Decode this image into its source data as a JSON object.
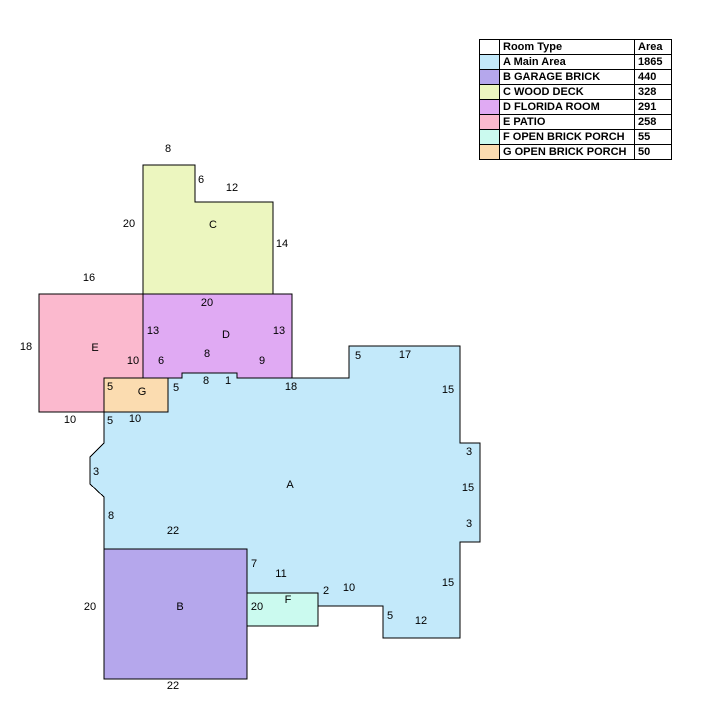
{
  "legend": {
    "header_swatch": "",
    "header_room_type": "Room Type",
    "header_area": "Area",
    "rows": [
      {
        "color": "#C3E9FA",
        "label": "A Main Area",
        "area": "1865"
      },
      {
        "color": "#B5A7EC",
        "label": "B GARAGE BRICK",
        "area": "440"
      },
      {
        "color": "#ECF6BF",
        "label": "C WOOD DECK",
        "area": "328"
      },
      {
        "color": "#E0AAF3",
        "label": "D FLORIDA ROOM",
        "area": "291"
      },
      {
        "color": "#FBB9CE",
        "label": "E PATIO",
        "area": "258"
      },
      {
        "color": "#CBFAEF",
        "label": "F OPEN BRICK PORCH",
        "area": "55"
      },
      {
        "color": "#FBDCB0",
        "label": "G OPEN BRICK PORCH",
        "area": "50"
      }
    ]
  },
  "floorplan": {
    "line_color": "#000000",
    "regions": [
      {
        "id": "A",
        "letter": "A",
        "room_type": "Main Area",
        "color": "#C3E9FA",
        "letter_x": 290,
        "letter_y": 485,
        "points": [
          [
            104,
            412
          ],
          [
            168,
            412
          ],
          [
            168,
            378
          ],
          [
            182,
            378
          ],
          [
            182,
            373
          ],
          [
            237,
            373
          ],
          [
            237,
            378
          ],
          [
            349,
            378
          ],
          [
            349,
            346
          ],
          [
            460,
            346
          ],
          [
            460,
            443
          ],
          [
            480,
            443
          ],
          [
            480,
            542
          ],
          [
            460,
            542
          ],
          [
            460,
            638
          ],
          [
            383,
            638
          ],
          [
            383,
            606
          ],
          [
            317,
            606
          ],
          [
            317,
            593
          ],
          [
            247,
            593
          ],
          [
            247,
            549
          ],
          [
            104,
            549
          ],
          [
            104,
            497
          ],
          [
            90,
            484
          ],
          [
            90,
            457
          ],
          [
            104,
            443
          ]
        ]
      },
      {
        "id": "E",
        "letter": "E",
        "room_type": "PATIO",
        "color": "#FBB9CE",
        "letter_x": 95,
        "letter_y": 348,
        "points": [
          [
            39,
            294
          ],
          [
            143,
            294
          ],
          [
            143,
            378
          ],
          [
            104,
            378
          ],
          [
            104,
            412
          ],
          [
            39,
            412
          ]
        ]
      },
      {
        "id": "C",
        "letter": "C",
        "room_type": "WOOD DECK",
        "color": "#ECF6BF",
        "letter_x": 213,
        "letter_y": 225,
        "points": [
          [
            143,
            165
          ],
          [
            195,
            165
          ],
          [
            195,
            202
          ],
          [
            273,
            202
          ],
          [
            273,
            294
          ],
          [
            143,
            294
          ]
        ]
      },
      {
        "id": "D",
        "letter": "D",
        "room_type": "FLORIDA ROOM",
        "color": "#E0AAF3",
        "letter_x": 226,
        "letter_y": 335,
        "points": [
          [
            143,
            294
          ],
          [
            292,
            294
          ],
          [
            292,
            378
          ],
          [
            237,
            378
          ],
          [
            237,
            373
          ],
          [
            182,
            373
          ],
          [
            182,
            378
          ],
          [
            143,
            378
          ]
        ]
      },
      {
        "id": "G",
        "letter": "G",
        "room_type": "OPEN BRICK PORCH",
        "color": "#FBDCB0",
        "letter_x": 142,
        "letter_y": 392,
        "points": [
          [
            104,
            378
          ],
          [
            168,
            378
          ],
          [
            168,
            412
          ],
          [
            104,
            412
          ]
        ]
      },
      {
        "id": "B",
        "letter": "B",
        "room_type": "GARAGE BRICK",
        "color": "#B5A7EC",
        "letter_x": 180,
        "letter_y": 607,
        "points": [
          [
            104,
            549
          ],
          [
            247,
            549
          ],
          [
            247,
            679
          ],
          [
            104,
            679
          ]
        ]
      },
      {
        "id": "F",
        "letter": "F",
        "room_type": "OPEN BRICK PORCH",
        "color": "#CBFAEF",
        "letter_x": 288,
        "letter_y": 600,
        "points": [
          [
            247,
            593
          ],
          [
            318,
            593
          ],
          [
            318,
            626
          ],
          [
            247,
            626
          ]
        ]
      }
    ],
    "dimension_labels": [
      {
        "text": "8",
        "x": 168,
        "y": 149
      },
      {
        "text": "6",
        "x": 201,
        "y": 180
      },
      {
        "text": "12",
        "x": 232,
        "y": 188
      },
      {
        "text": "20",
        "x": 129,
        "y": 224
      },
      {
        "text": "14",
        "x": 282,
        "y": 244
      },
      {
        "text": "16",
        "x": 89,
        "y": 278
      },
      {
        "text": "18",
        "x": 26,
        "y": 347
      },
      {
        "text": "10",
        "x": 70,
        "y": 420
      },
      {
        "text": "20",
        "x": 207,
        "y": 303
      },
      {
        "text": "13",
        "x": 153,
        "y": 331
      },
      {
        "text": "13",
        "x": 279,
        "y": 331
      },
      {
        "text": "10",
        "x": 133,
        "y": 361
      },
      {
        "text": "6",
        "x": 161,
        "y": 361
      },
      {
        "text": "8",
        "x": 207,
        "y": 354
      },
      {
        "text": "9",
        "x": 262,
        "y": 361
      },
      {
        "text": "5",
        "x": 110,
        "y": 387
      },
      {
        "text": "5",
        "x": 176,
        "y": 388
      },
      {
        "text": "5",
        "x": 110,
        "y": 421
      },
      {
        "text": "10",
        "x": 135,
        "y": 419
      },
      {
        "text": "8",
        "x": 206,
        "y": 381
      },
      {
        "text": "1",
        "x": 228,
        "y": 381
      },
      {
        "text": "18",
        "x": 291,
        "y": 387
      },
      {
        "text": "5",
        "x": 358,
        "y": 356
      },
      {
        "text": "17",
        "x": 405,
        "y": 355
      },
      {
        "text": "15",
        "x": 448,
        "y": 390
      },
      {
        "text": "3",
        "x": 469,
        "y": 452
      },
      {
        "text": "15",
        "x": 468,
        "y": 488
      },
      {
        "text": "3",
        "x": 469,
        "y": 524
      },
      {
        "text": "15",
        "x": 448,
        "y": 583
      },
      {
        "text": "12",
        "x": 421,
        "y": 621
      },
      {
        "text": "5",
        "x": 390,
        "y": 616
      },
      {
        "text": "10",
        "x": 349,
        "y": 588
      },
      {
        "text": "2",
        "x": 326,
        "y": 591
      },
      {
        "text": "11",
        "x": 281,
        "y": 574
      },
      {
        "text": "7",
        "x": 254,
        "y": 564
      },
      {
        "text": "22",
        "x": 173,
        "y": 531
      },
      {
        "text": "8",
        "x": 111,
        "y": 516
      },
      {
        "text": "3",
        "x": 96,
        "y": 472
      },
      {
        "text": "20",
        "x": 90,
        "y": 607
      },
      {
        "text": "20",
        "x": 257,
        "y": 607
      },
      {
        "text": "22",
        "x": 173,
        "y": 686
      }
    ]
  }
}
